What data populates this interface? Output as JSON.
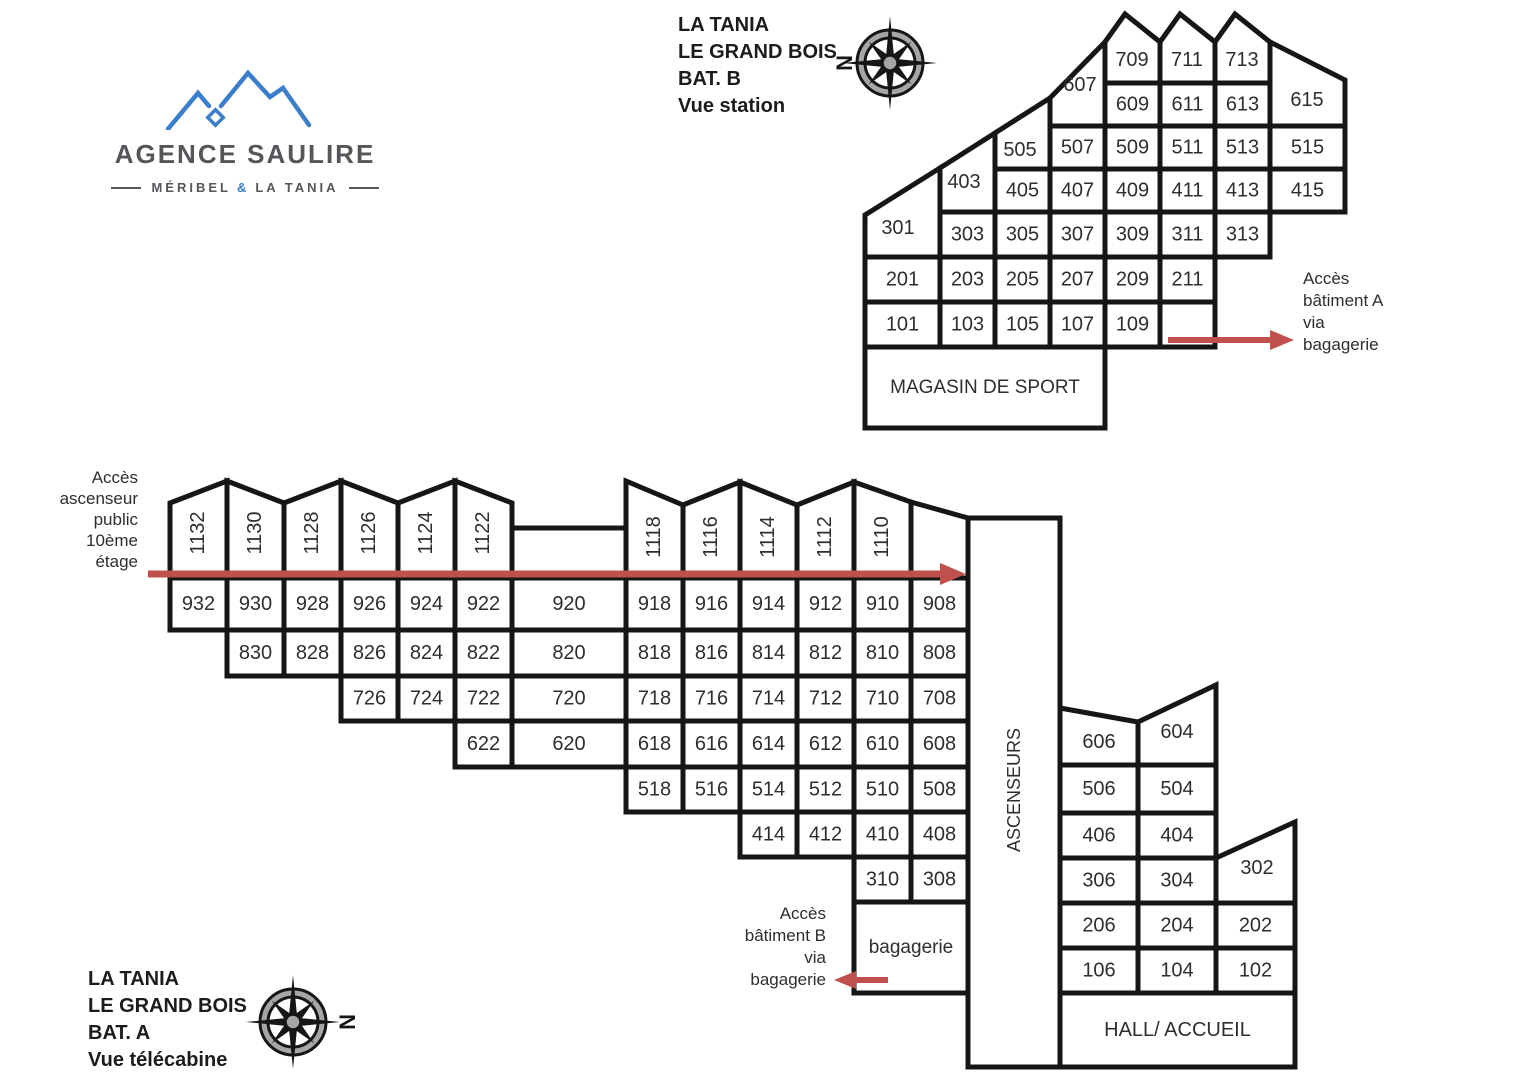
{
  "logo": {
    "title": "AGENCE SAULIRE",
    "subtitle": [
      "MÉRIBEL",
      "&",
      "LA TANIA"
    ]
  },
  "header_b": {
    "lines": [
      "LA TANIA",
      "LE GRAND BOIS",
      "BAT. B",
      "Vue station"
    ]
  },
  "header_a": {
    "lines": [
      "LA TANIA",
      "LE GRAND BOIS",
      "BAT. A",
      "Vue télécabine"
    ]
  },
  "notes": {
    "access_a": [
      "Accès",
      "bâtiment A",
      "via",
      "bagagerie"
    ],
    "elevator": [
      "Accès",
      "ascenseur",
      "public",
      "10ème",
      "étage"
    ],
    "access_b": [
      "Accès",
      "bâtiment B",
      "via",
      "bagagerie"
    ]
  },
  "compass_n": "N",
  "colors": {
    "line": "#161616",
    "text": "#2e2e2e",
    "arrow": "#c0504d",
    "logo_blue": "#3b7ec9",
    "logo_gray": "#54565a",
    "compass_ring": "#a6a6a6"
  },
  "floorplan": {
    "bat_b": {
      "cells": [
        {
          "t": "301",
          "p": "865,215 940,168 940,257 865,257",
          "lx": 898,
          "ly": 228
        },
        {
          "t": "403",
          "p": "940,168 995,133 995,212 940,212",
          "lx": 964,
          "ly": 182
        },
        {
          "t": "505",
          "p": "995,133 1050,98 1050,169 995,169",
          "lx": 1020,
          "ly": 150
        },
        {
          "t": "607",
          "p": "1050,98 1105,42 1105,126 1050,126",
          "lx": 1080,
          "ly": 85
        },
        {
          "t": "709",
          "p": "1105,42 1125,14 1160,42 1160,83 1105,83",
          "lx": 1132,
          "ly": 60
        },
        {
          "t": "711",
          "p": "1160,42 1180,14 1215,42 1215,83 1160,83",
          "lx": 1187,
          "ly": 60
        },
        {
          "t": "713",
          "p": "1215,42 1235,14 1270,42 1270,83 1215,83",
          "lx": 1242,
          "ly": 60
        },
        {
          "t": "615",
          "p": "1270,42 1345,80 1345,126 1270,126",
          "lx": 1307,
          "ly": 100
        },
        {
          "t": "609",
          "x": 1105,
          "y": 83,
          "w": 55,
          "h": 43
        },
        {
          "t": "611",
          "x": 1160,
          "y": 83,
          "w": 55,
          "h": 43
        },
        {
          "t": "613",
          "x": 1215,
          "y": 83,
          "w": 55,
          "h": 43
        },
        {
          "t": "507",
          "x": 1050,
          "y": 126,
          "w": 55,
          "h": 43
        },
        {
          "t": "509",
          "x": 1105,
          "y": 126,
          "w": 55,
          "h": 43
        },
        {
          "t": "511",
          "x": 1160,
          "y": 126,
          "w": 55,
          "h": 43
        },
        {
          "t": "513",
          "x": 1215,
          "y": 126,
          "w": 55,
          "h": 43
        },
        {
          "t": "515",
          "x": 1270,
          "y": 126,
          "w": 75,
          "h": 43
        },
        {
          "t": "405",
          "x": 995,
          "y": 169,
          "w": 55,
          "h": 43
        },
        {
          "t": "407",
          "x": 1050,
          "y": 169,
          "w": 55,
          "h": 43
        },
        {
          "t": "409",
          "x": 1105,
          "y": 169,
          "w": 55,
          "h": 43
        },
        {
          "t": "411",
          "x": 1160,
          "y": 169,
          "w": 55,
          "h": 43
        },
        {
          "t": "413",
          "x": 1215,
          "y": 169,
          "w": 55,
          "h": 43
        },
        {
          "t": "415",
          "x": 1270,
          "y": 169,
          "w": 75,
          "h": 43
        },
        {
          "t": "303",
          "x": 940,
          "y": 212,
          "w": 55,
          "h": 45
        },
        {
          "t": "305",
          "x": 995,
          "y": 212,
          "w": 55,
          "h": 45
        },
        {
          "t": "307",
          "x": 1050,
          "y": 212,
          "w": 55,
          "h": 45
        },
        {
          "t": "309",
          "x": 1105,
          "y": 212,
          "w": 55,
          "h": 45
        },
        {
          "t": "311",
          "x": 1160,
          "y": 212,
          "w": 55,
          "h": 45
        },
        {
          "t": "313",
          "x": 1215,
          "y": 212,
          "w": 55,
          "h": 45
        },
        {
          "t": "201",
          "x": 865,
          "y": 257,
          "w": 75,
          "h": 45
        },
        {
          "t": "203",
          "x": 940,
          "y": 257,
          "w": 55,
          "h": 45
        },
        {
          "t": "205",
          "x": 995,
          "y": 257,
          "w": 55,
          "h": 45
        },
        {
          "t": "207",
          "x": 1050,
          "y": 257,
          "w": 55,
          "h": 45
        },
        {
          "t": "209",
          "x": 1105,
          "y": 257,
          "w": 55,
          "h": 45
        },
        {
          "t": "211",
          "x": 1160,
          "y": 257,
          "w": 55,
          "h": 45
        },
        {
          "t": "101",
          "x": 865,
          "y": 302,
          "w": 75,
          "h": 45
        },
        {
          "t": "103",
          "x": 940,
          "y": 302,
          "w": 55,
          "h": 45
        },
        {
          "t": "105",
          "x": 995,
          "y": 302,
          "w": 55,
          "h": 45
        },
        {
          "t": "107",
          "x": 1050,
          "y": 302,
          "w": 55,
          "h": 45
        },
        {
          "t": "109",
          "x": 1105,
          "y": 302,
          "w": 55,
          "h": 45
        },
        {
          "t": "",
          "x": 1160,
          "y": 302,
          "w": 55,
          "h": 45
        },
        {
          "t": "MAGASIN DE SPORT",
          "x": 865,
          "y": 347,
          "w": 240,
          "h": 81,
          "fs": 19
        }
      ]
    },
    "bat_a": {
      "cells": [
        {
          "t": "1132",
          "p": "170,503 227,481 227,578 170,578",
          "lx": 198,
          "ly": 533,
          "r": 1
        },
        {
          "t": "1130",
          "p": "227,481 284,503 284,578 227,578",
          "lx": 255,
          "ly": 533,
          "r": 1
        },
        {
          "t": "1128",
          "p": "284,503 341,481 341,578 284,578",
          "lx": 312,
          "ly": 533,
          "r": 1
        },
        {
          "t": "1126",
          "p": "341,481 398,503 398,578 341,578",
          "lx": 369,
          "ly": 533,
          "r": 1
        },
        {
          "t": "1124",
          "p": "398,503 455,481 455,578 398,578",
          "lx": 426,
          "ly": 533,
          "r": 1
        },
        {
          "t": "1122",
          "p": "455,481 512,503 512,578 455,578",
          "lx": 483,
          "ly": 533,
          "r": 1
        },
        {
          "t": "",
          "p": "512,528 626,528 626,578 512,578"
        },
        {
          "t": "1118",
          "p": "626,481 683,505 683,578 626,578",
          "lx": 654,
          "ly": 537,
          "r": 1
        },
        {
          "t": "1116",
          "p": "683,505 740,482 740,578 683,578",
          "lx": 711,
          "ly": 537,
          "r": 1
        },
        {
          "t": "1114",
          "p": "740,482 797,505 797,578 740,578",
          "lx": 768,
          "ly": 537,
          "r": 1
        },
        {
          "t": "1112",
          "p": "797,505 854,482 854,578 797,578",
          "lx": 825,
          "ly": 537,
          "r": 1
        },
        {
          "t": "1110",
          "p": "854,482 911,502 911,578 854,578",
          "lx": 882,
          "ly": 537,
          "r": 1
        },
        {
          "t": "",
          "p": "911,502 968,518 968,578 911,578"
        },
        {
          "t": "932",
          "x": 170,
          "y": 578,
          "w": 57,
          "h": 52
        },
        {
          "t": "930",
          "x": 227,
          "y": 578,
          "w": 57,
          "h": 52
        },
        {
          "t": "928",
          "x": 284,
          "y": 578,
          "w": 57,
          "h": 52
        },
        {
          "t": "926",
          "x": 341,
          "y": 578,
          "w": 57,
          "h": 52
        },
        {
          "t": "924",
          "x": 398,
          "y": 578,
          "w": 57,
          "h": 52
        },
        {
          "t": "922",
          "x": 455,
          "y": 578,
          "w": 57,
          "h": 52
        },
        {
          "t": "920",
          "x": 512,
          "y": 578,
          "w": 114,
          "h": 52
        },
        {
          "t": "918",
          "x": 626,
          "y": 578,
          "w": 57,
          "h": 52
        },
        {
          "t": "916",
          "x": 683,
          "y": 578,
          "w": 57,
          "h": 52
        },
        {
          "t": "914",
          "x": 740,
          "y": 578,
          "w": 57,
          "h": 52
        },
        {
          "t": "912",
          "x": 797,
          "y": 578,
          "w": 57,
          "h": 52
        },
        {
          "t": "910",
          "x": 854,
          "y": 578,
          "w": 57,
          "h": 52
        },
        {
          "t": "908",
          "x": 911,
          "y": 578,
          "w": 57,
          "h": 52
        },
        {
          "t": "830",
          "x": 227,
          "y": 630,
          "w": 57,
          "h": 46
        },
        {
          "t": "828",
          "x": 284,
          "y": 630,
          "w": 57,
          "h": 46
        },
        {
          "t": "826",
          "x": 341,
          "y": 630,
          "w": 57,
          "h": 46
        },
        {
          "t": "824",
          "x": 398,
          "y": 630,
          "w": 57,
          "h": 46
        },
        {
          "t": "822",
          "x": 455,
          "y": 630,
          "w": 57,
          "h": 46
        },
        {
          "t": "820",
          "x": 512,
          "y": 630,
          "w": 114,
          "h": 46
        },
        {
          "t": "818",
          "x": 626,
          "y": 630,
          "w": 57,
          "h": 46
        },
        {
          "t": "816",
          "x": 683,
          "y": 630,
          "w": 57,
          "h": 46
        },
        {
          "t": "814",
          "x": 740,
          "y": 630,
          "w": 57,
          "h": 46
        },
        {
          "t": "812",
          "x": 797,
          "y": 630,
          "w": 57,
          "h": 46
        },
        {
          "t": "810",
          "x": 854,
          "y": 630,
          "w": 57,
          "h": 46
        },
        {
          "t": "808",
          "x": 911,
          "y": 630,
          "w": 57,
          "h": 46
        },
        {
          "t": "726",
          "x": 341,
          "y": 676,
          "w": 57,
          "h": 45
        },
        {
          "t": "724",
          "x": 398,
          "y": 676,
          "w": 57,
          "h": 45
        },
        {
          "t": "722",
          "x": 455,
          "y": 676,
          "w": 57,
          "h": 45
        },
        {
          "t": "720",
          "x": 512,
          "y": 676,
          "w": 114,
          "h": 45
        },
        {
          "t": "718",
          "x": 626,
          "y": 676,
          "w": 57,
          "h": 45
        },
        {
          "t": "716",
          "x": 683,
          "y": 676,
          "w": 57,
          "h": 45
        },
        {
          "t": "714",
          "x": 740,
          "y": 676,
          "w": 57,
          "h": 45
        },
        {
          "t": "712",
          "x": 797,
          "y": 676,
          "w": 57,
          "h": 45
        },
        {
          "t": "710",
          "x": 854,
          "y": 676,
          "w": 57,
          "h": 45
        },
        {
          "t": "708",
          "x": 911,
          "y": 676,
          "w": 57,
          "h": 45
        },
        {
          "t": "622",
          "x": 455,
          "y": 721,
          "w": 57,
          "h": 46
        },
        {
          "t": "620",
          "x": 512,
          "y": 721,
          "w": 114,
          "h": 46
        },
        {
          "t": "618",
          "x": 626,
          "y": 721,
          "w": 57,
          "h": 46
        },
        {
          "t": "616",
          "x": 683,
          "y": 721,
          "w": 57,
          "h": 46
        },
        {
          "t": "614",
          "x": 740,
          "y": 721,
          "w": 57,
          "h": 46
        },
        {
          "t": "612",
          "x": 797,
          "y": 721,
          "w": 57,
          "h": 46
        },
        {
          "t": "610",
          "x": 854,
          "y": 721,
          "w": 57,
          "h": 46
        },
        {
          "t": "608",
          "x": 911,
          "y": 721,
          "w": 57,
          "h": 46
        },
        {
          "t": "518",
          "x": 626,
          "y": 767,
          "w": 57,
          "h": 45
        },
        {
          "t": "516",
          "x": 683,
          "y": 767,
          "w": 57,
          "h": 45
        },
        {
          "t": "514",
          "x": 740,
          "y": 767,
          "w": 57,
          "h": 45
        },
        {
          "t": "512",
          "x": 797,
          "y": 767,
          "w": 57,
          "h": 45
        },
        {
          "t": "510",
          "x": 854,
          "y": 767,
          "w": 57,
          "h": 45
        },
        {
          "t": "508",
          "x": 911,
          "y": 767,
          "w": 57,
          "h": 45
        },
        {
          "t": "414",
          "x": 740,
          "y": 812,
          "w": 57,
          "h": 45
        },
        {
          "t": "412",
          "x": 797,
          "y": 812,
          "w": 57,
          "h": 45
        },
        {
          "t": "410",
          "x": 854,
          "y": 812,
          "w": 57,
          "h": 45
        },
        {
          "t": "408",
          "x": 911,
          "y": 812,
          "w": 57,
          "h": 45
        },
        {
          "t": "310",
          "x": 854,
          "y": 857,
          "w": 57,
          "h": 45
        },
        {
          "t": "308",
          "x": 911,
          "y": 857,
          "w": 57,
          "h": 45
        },
        {
          "t": "bagagerie",
          "x": 854,
          "y": 902,
          "w": 114,
          "h": 91,
          "fs": 19
        },
        {
          "t": "ASCENSEURS",
          "x": 968,
          "y": 518,
          "w": 92,
          "h": 549,
          "r": 1,
          "lx": 1014,
          "ly": 790,
          "fs": 18
        },
        {
          "t": "606",
          "p": "1060,708 1138,722 1138,765 1060,765",
          "lx": 1099,
          "ly": 742
        },
        {
          "t": "604",
          "p": "1138,722 1216,685 1216,765 1138,765",
          "lx": 1177,
          "ly": 732
        },
        {
          "t": "506",
          "x": 1060,
          "y": 765,
          "w": 78,
          "h": 48
        },
        {
          "t": "504",
          "x": 1138,
          "y": 765,
          "w": 78,
          "h": 48
        },
        {
          "t": "406",
          "x": 1060,
          "y": 813,
          "w": 78,
          "h": 45
        },
        {
          "t": "404",
          "x": 1138,
          "y": 813,
          "w": 78,
          "h": 45
        },
        {
          "t": "306",
          "x": 1060,
          "y": 858,
          "w": 78,
          "h": 45
        },
        {
          "t": "304",
          "x": 1138,
          "y": 858,
          "w": 78,
          "h": 45
        },
        {
          "t": "302",
          "p": "1216,858 1295,822 1295,903 1216,903",
          "lx": 1257,
          "ly": 868
        },
        {
          "t": "206",
          "x": 1060,
          "y": 903,
          "w": 78,
          "h": 45
        },
        {
          "t": "204",
          "x": 1138,
          "y": 903,
          "w": 78,
          "h": 45
        },
        {
          "t": "202",
          "x": 1216,
          "y": 903,
          "w": 79,
          "h": 45
        },
        {
          "t": "106",
          "x": 1060,
          "y": 948,
          "w": 78,
          "h": 45
        },
        {
          "t": "104",
          "x": 1138,
          "y": 948,
          "w": 78,
          "h": 45
        },
        {
          "t": "102",
          "x": 1216,
          "y": 948,
          "w": 79,
          "h": 45
        },
        {
          "t": "HALL/ ACCUEIL",
          "x": 1060,
          "y": 993,
          "w": 235,
          "h": 74,
          "fs": 20
        }
      ]
    },
    "arrows": [
      {
        "x1": 148,
        "y1": 574,
        "x2": 940,
        "y2": 574,
        "dir": "r",
        "w": 7,
        "hl": 26,
        "hw": 11
      },
      {
        "x1": 1168,
        "y1": 340,
        "x2": 1270,
        "y2": 340,
        "dir": "r",
        "w": 6,
        "hl": 24,
        "hw": 10
      },
      {
        "x1": 888,
        "y1": 980,
        "x2": 856,
        "y2": 980,
        "dir": "l",
        "w": 6,
        "hl": 22,
        "hw": 9
      }
    ],
    "compasses": [
      {
        "cx": 890,
        "cy": 63,
        "nx": 844,
        "ny": 63
      },
      {
        "cx": 293,
        "cy": 1022,
        "nx": 347,
        "ny": 1022
      }
    ]
  }
}
